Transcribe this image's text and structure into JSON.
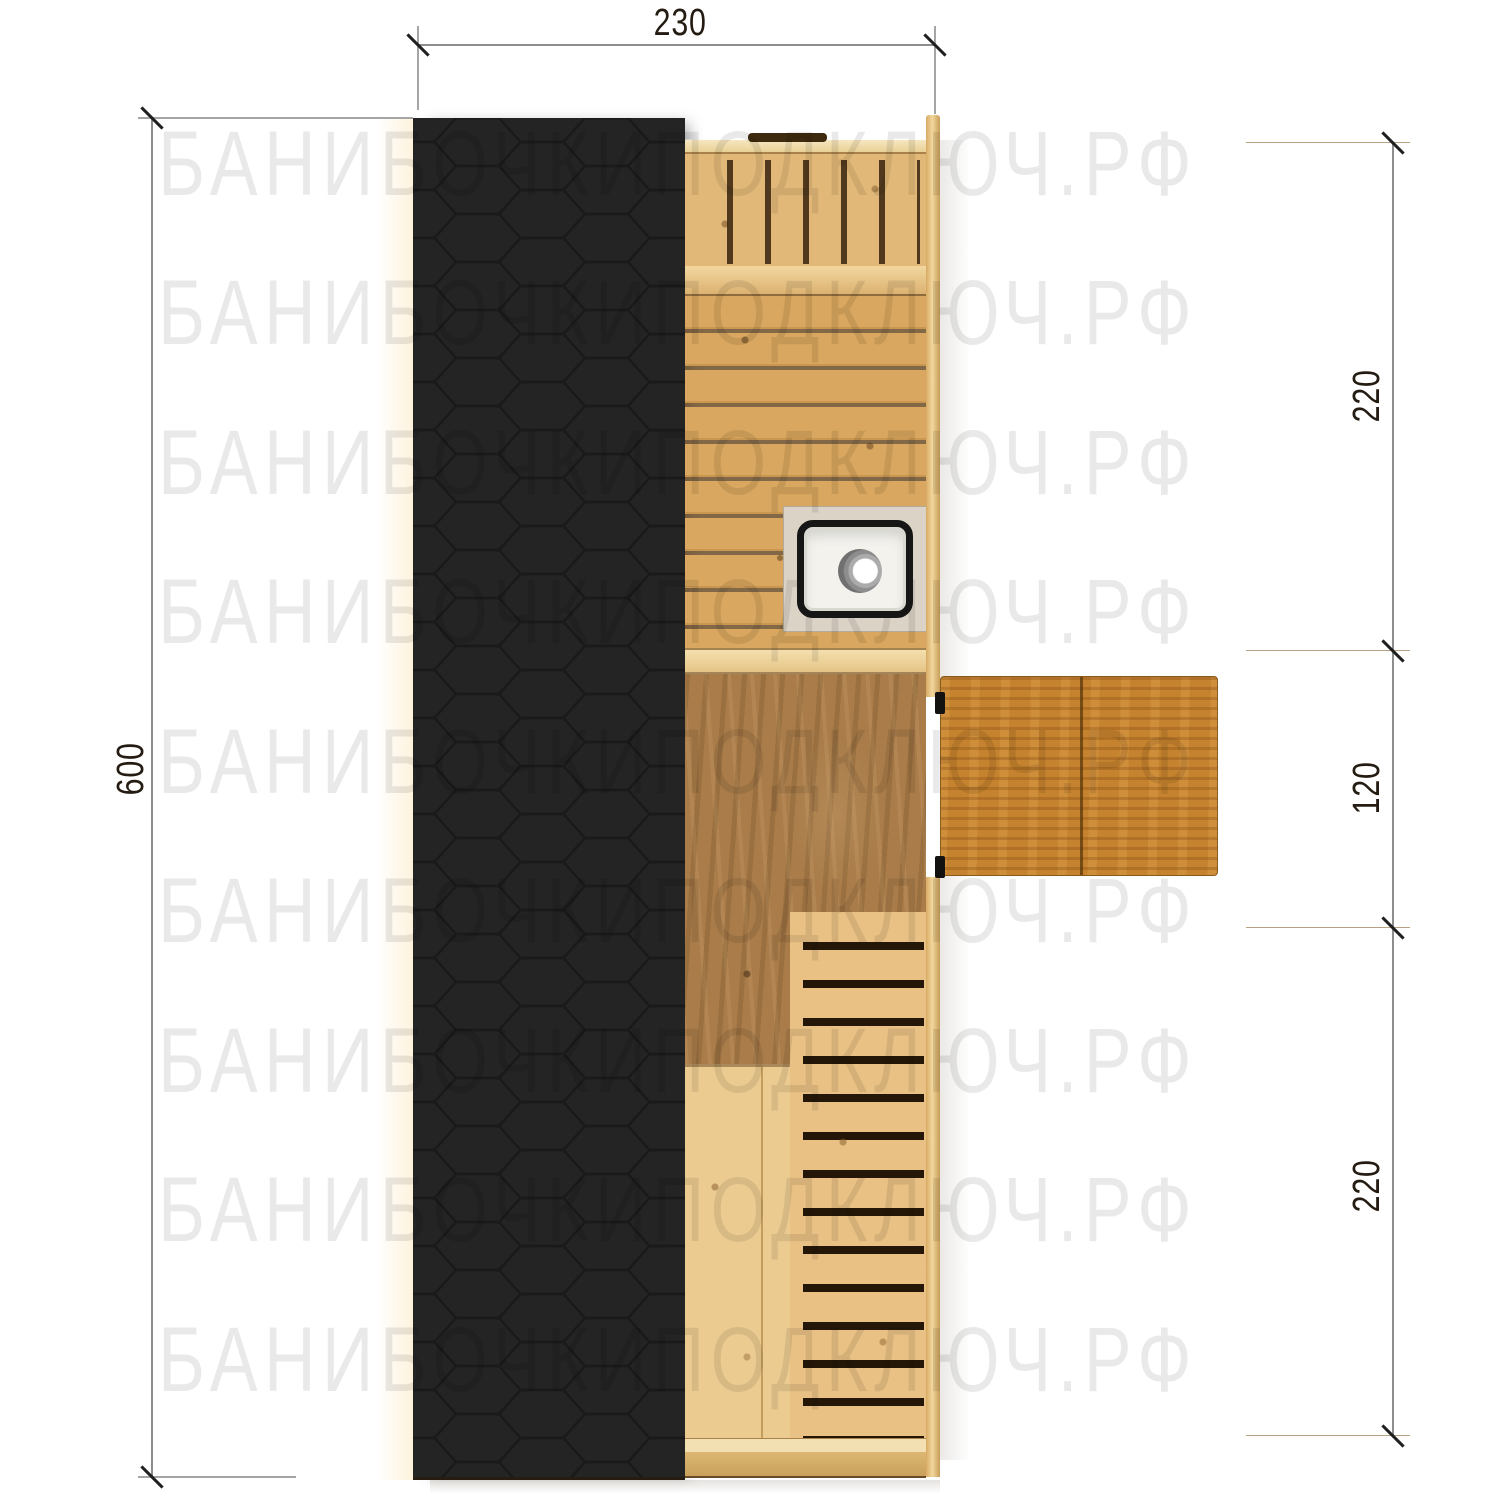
{
  "watermark": {
    "text": "БАНИБОЧКИПОДКЛЮЧ.РФ",
    "color": "#ebebeb"
  },
  "dimensions": {
    "top_width": "230",
    "left_height": "600",
    "right_top": "220",
    "right_middle": "120",
    "right_bottom": "220"
  },
  "plan": {
    "type": "sauna-floor-plan-top-view",
    "colors": {
      "roof": "#242424",
      "roof_hex_line": "#1a1a1a",
      "wood_light": "#e2b878",
      "wood_medium": "#d9a75f",
      "wood_floor": "#a97c49",
      "wood_door": "#c5832f",
      "sink_rim": "#161616",
      "sink_basin": "#f3f2ed",
      "dimension_text": "#241c12"
    }
  }
}
